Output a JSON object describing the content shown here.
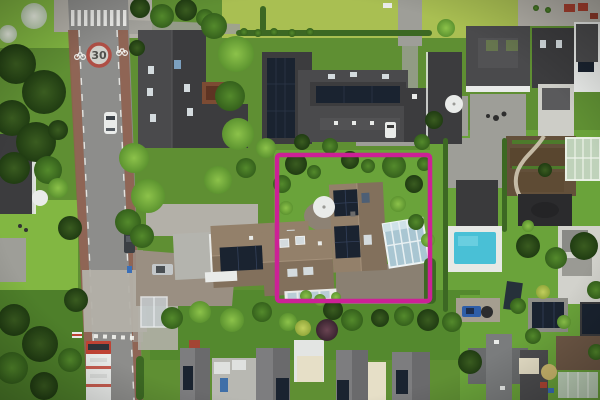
{
  "scene": {
    "type": "aerial-photograph",
    "description": "Top-down drone photo of a Dutch suburban neighborhood. A magenta rectangle annotates the featured property: a brown-tiled house with rooftop solar panels, a glass conservatory, white parasol and landscaped garden. A street with red cycle lanes, a zebra crossing, a 30 km/h road marking and a red-white bus runs along the left; neighboring villas, row houses, two swimming pools, a greenhouse and a vegetable garden surround the plot.",
    "annotation": {
      "label": "property-highlight",
      "x": 277,
      "y": 155,
      "width": 153,
      "height": 146,
      "stroke_px": 4.5,
      "color": "#cc2196"
    },
    "road": {
      "speed_marking": "30",
      "features": [
        "zebra crossing",
        "red cycle lanes",
        "dashed lane lines",
        "give-way marks",
        "bus stop shelter"
      ],
      "vehicles": [
        "white car northbound",
        "dark car parked",
        "red-white bus southbound",
        "silver car in driveway",
        "white car at mansion",
        "blue car in driveway"
      ]
    },
    "landmarks": [
      "highlighted villa with solar panels",
      "glass conservatory",
      "white garden parasols",
      "swimming pool with white deck",
      "second pool near bottom right",
      "greenhouse",
      "vegetable garden with path",
      "dark garden sheds",
      "row houses with awnings and solar panels",
      "mansion with large solar arrays",
      "plum-colored ornamental tree"
    ],
    "palette": {
      "base_green": "#5f8f33",
      "grass_bright": "#82b742",
      "grass_lime": "#a9bf52",
      "lawn_right": "#6aa33a",
      "garden_dark": "#54892e",
      "asphalt": "#8d8d8b",
      "bike_lane": "#8f604f",
      "paving_light": "#b3b0a8",
      "paving_mid": "#9e9e98",
      "brick_drive": "#9a8f82",
      "roof_dark_a": "#4a4a4c",
      "roof_dark_b": "#3c3c3e",
      "roof_gray_a": "#7d7d7f",
      "roof_gray_b": "#6a6a6c",
      "roof_brown_a": "#93806a",
      "roof_brown_b": "#82705c",
      "roof_rust": "#7c4b33",
      "solar_panel": "#1a2330",
      "skylight": "#d4dbde",
      "glass_blue": "#a9c6d2",
      "white_struct": "#e9ebe9",
      "cream_awning": "#e6dfc7",
      "pool_water": "#49c0d6",
      "pool_deck": "#e7e9e5",
      "soil": "#63503a",
      "greenhouse_glass": "#bfd2ba",
      "hedge_green": "#3c6823",
      "highlight_magenta": "#cc2196",
      "bus_red": "#bf4334",
      "car_blue": "#2e5ea8"
    }
  }
}
